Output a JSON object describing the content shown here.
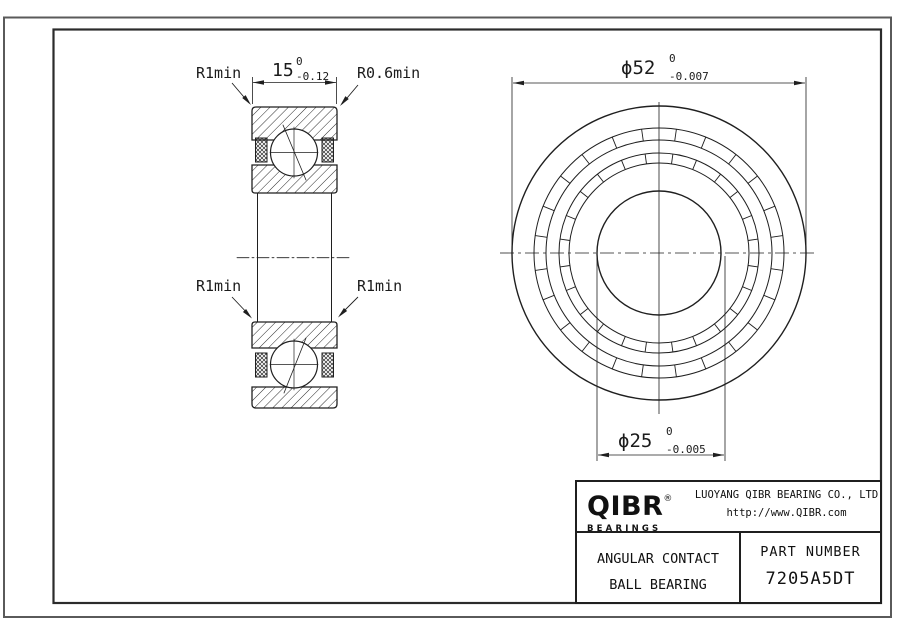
{
  "sheet": {
    "background": "#ffffff",
    "line_color": "#1f1f1f"
  },
  "section_view": {
    "width_dim": {
      "value": "15",
      "tol_upper": "0",
      "tol_lower": "-0.12"
    },
    "labels": {
      "top_left": "R1min",
      "top_right": "R0.6min",
      "mid_left": "R1min",
      "mid_right": "R1min"
    }
  },
  "front_view": {
    "od_dim": {
      "value": "ϕ52",
      "tol_upper": "0",
      "tol_lower": "-0.007"
    },
    "bore_dim": {
      "value": "ϕ25",
      "tol_upper": "0",
      "tol_lower": "-0.005"
    }
  },
  "title_block": {
    "logo_text": "QIBR",
    "logo_reg": "®",
    "logo_sub": "BEARINGS",
    "company": "LUOYANG QIBR BEARING CO., LTD",
    "website": "http://www.QIBR.com",
    "product_line1": "ANGULAR CONTACT",
    "product_line2": "BALL BEARING",
    "part_label": "PART NUMBER",
    "part_number": "7205A5DT"
  }
}
